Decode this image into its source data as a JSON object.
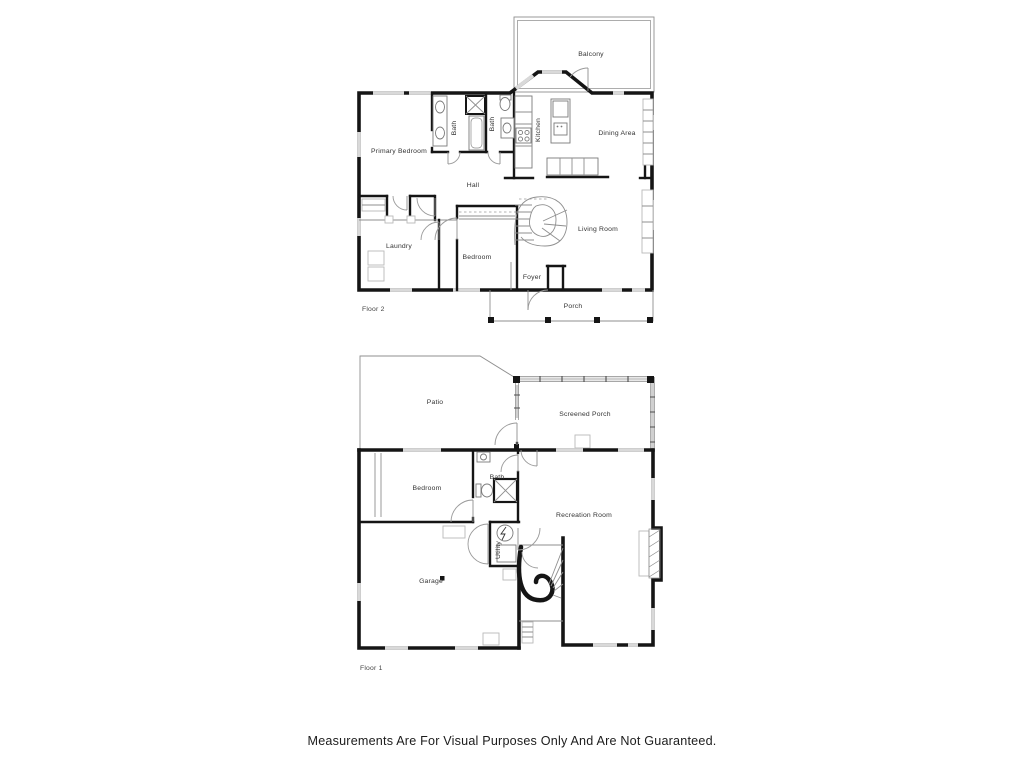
{
  "page": {
    "background": "#ffffff",
    "wall_color": "#151515",
    "window_color": "#d9d9d9",
    "disclaimer": "Measurements Are For Visual Purposes Only And Are Not Guaranteed."
  },
  "floor2": {
    "label": "Floor 2",
    "rooms": {
      "balcony": "Balcony",
      "primary_bedroom": "Primary Bedroom",
      "bath_a": "Bath",
      "bath_b": "Bath",
      "kitchen": "Kitchen",
      "dining_area": "Dining Area",
      "hall": "Hall",
      "laundry": "Laundry",
      "bedroom": "Bedroom",
      "living_room": "Living Room",
      "foyer": "Foyer",
      "porch": "Porch"
    }
  },
  "floor1": {
    "label": "Floor 1",
    "rooms": {
      "patio": "Patio",
      "screened_porch": "Screened Porch",
      "bedroom": "Bedroom",
      "bath": "Bath",
      "recreation_room": "Recreation Room",
      "utility": "Utility",
      "garage": "Garage"
    }
  }
}
